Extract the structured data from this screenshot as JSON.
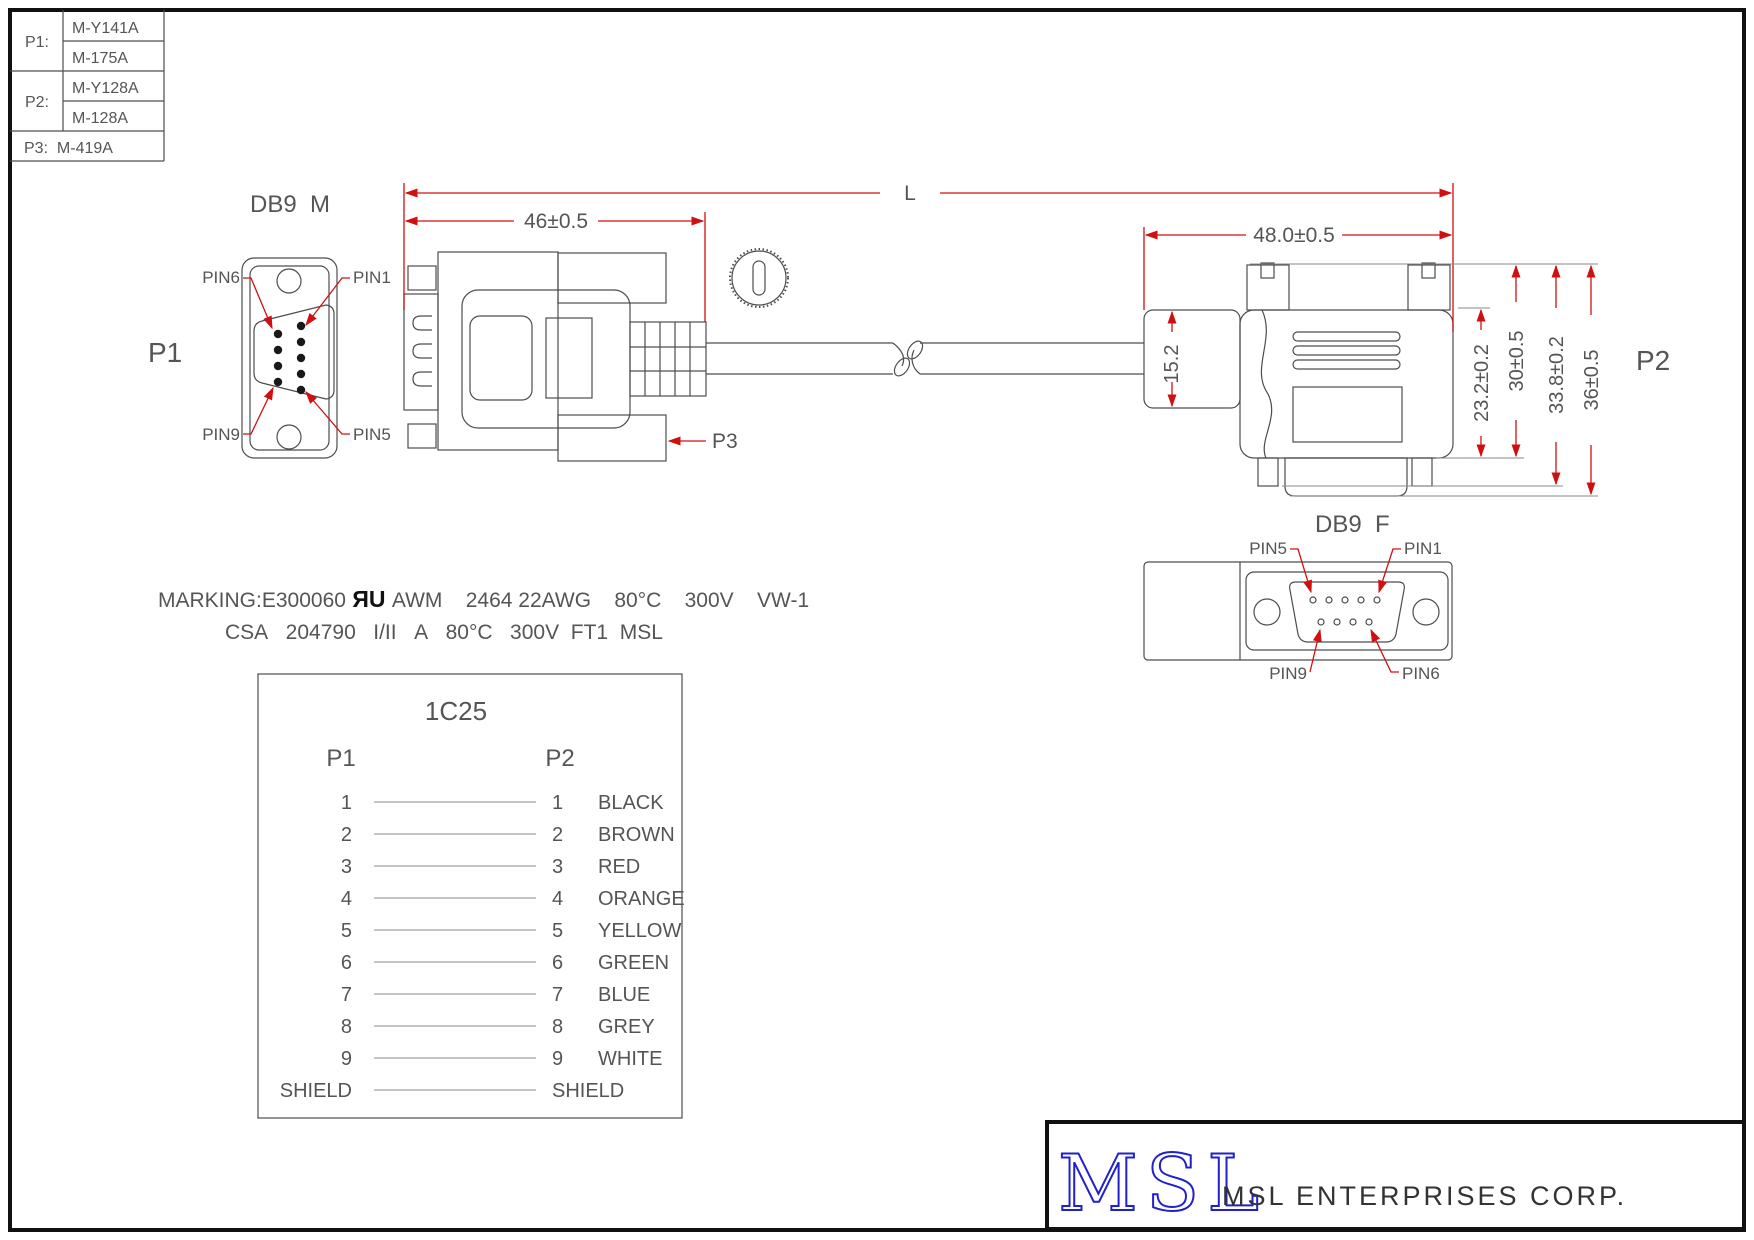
{
  "colors": {
    "dimension_red": "#d01010",
    "line_gray": "#4d4d4d",
    "text_gray": "#555555",
    "logo_blue": "#2121cc",
    "frame_black": "#111111"
  },
  "parts_table": {
    "p1_label": "P1:",
    "p1_value1": "M-Y141A",
    "p1_value2": "M-175A",
    "p2_label": "P2:",
    "p2_value1": "M-Y128A",
    "p2_value2": "M-128A",
    "p3_row": "P3:  M-419A"
  },
  "p1_view": {
    "title": "DB9  M",
    "ref": "P1",
    "pin_top_left": "PIN6",
    "pin_top_right": "PIN1",
    "pin_bottom_left": "PIN9",
    "pin_bottom_right": "PIN5"
  },
  "p2_face": {
    "title": "DB9  F",
    "pin_top_left": "PIN5",
    "pin_top_right": "PIN1",
    "pin_bottom_left": "PIN9",
    "pin_bottom_right": "PIN6"
  },
  "p2_ref": "P2",
  "p3_ref": "P3",
  "dims": {
    "overall": "L",
    "p1_len": "46±0.5",
    "p2_len": "48.0±0.5",
    "boot": "15.2",
    "d1": "23.2±0.2",
    "d2": "30±0.5",
    "d3": "33.8±0.2",
    "d4": "36±0.5"
  },
  "marking": {
    "prefix": "MARKING:E300060",
    "ul_mark": " ЯU ",
    "line1_rest": "AWM    2464 22AWG    80°C    300V    VW-1",
    "line2": "CSA   204790   I/II   A   80°C   300V  FT1  MSL"
  },
  "wiring": {
    "title": "1C25",
    "col_left": "P1",
    "col_right": "P2",
    "rows": [
      {
        "p1": "1",
        "p2": "1",
        "color": "BLACK"
      },
      {
        "p1": "2",
        "p2": "2",
        "color": "BROWN"
      },
      {
        "p1": "3",
        "p2": "3",
        "color": "RED"
      },
      {
        "p1": "4",
        "p2": "4",
        "color": "ORANGE"
      },
      {
        "p1": "5",
        "p2": "5",
        "color": "YELLOW"
      },
      {
        "p1": "6",
        "p2": "6",
        "color": "GREEN"
      },
      {
        "p1": "7",
        "p2": "7",
        "color": "BLUE"
      },
      {
        "p1": "8",
        "p2": "8",
        "color": "GREY"
      },
      {
        "p1": "9",
        "p2": "9",
        "color": "WHITE"
      },
      {
        "p1": "SHIELD",
        "p2": "SHIELD",
        "color": ""
      }
    ]
  },
  "title_block": {
    "logo": "MSL",
    "company": "MSL ENTERPRISES CORP."
  }
}
